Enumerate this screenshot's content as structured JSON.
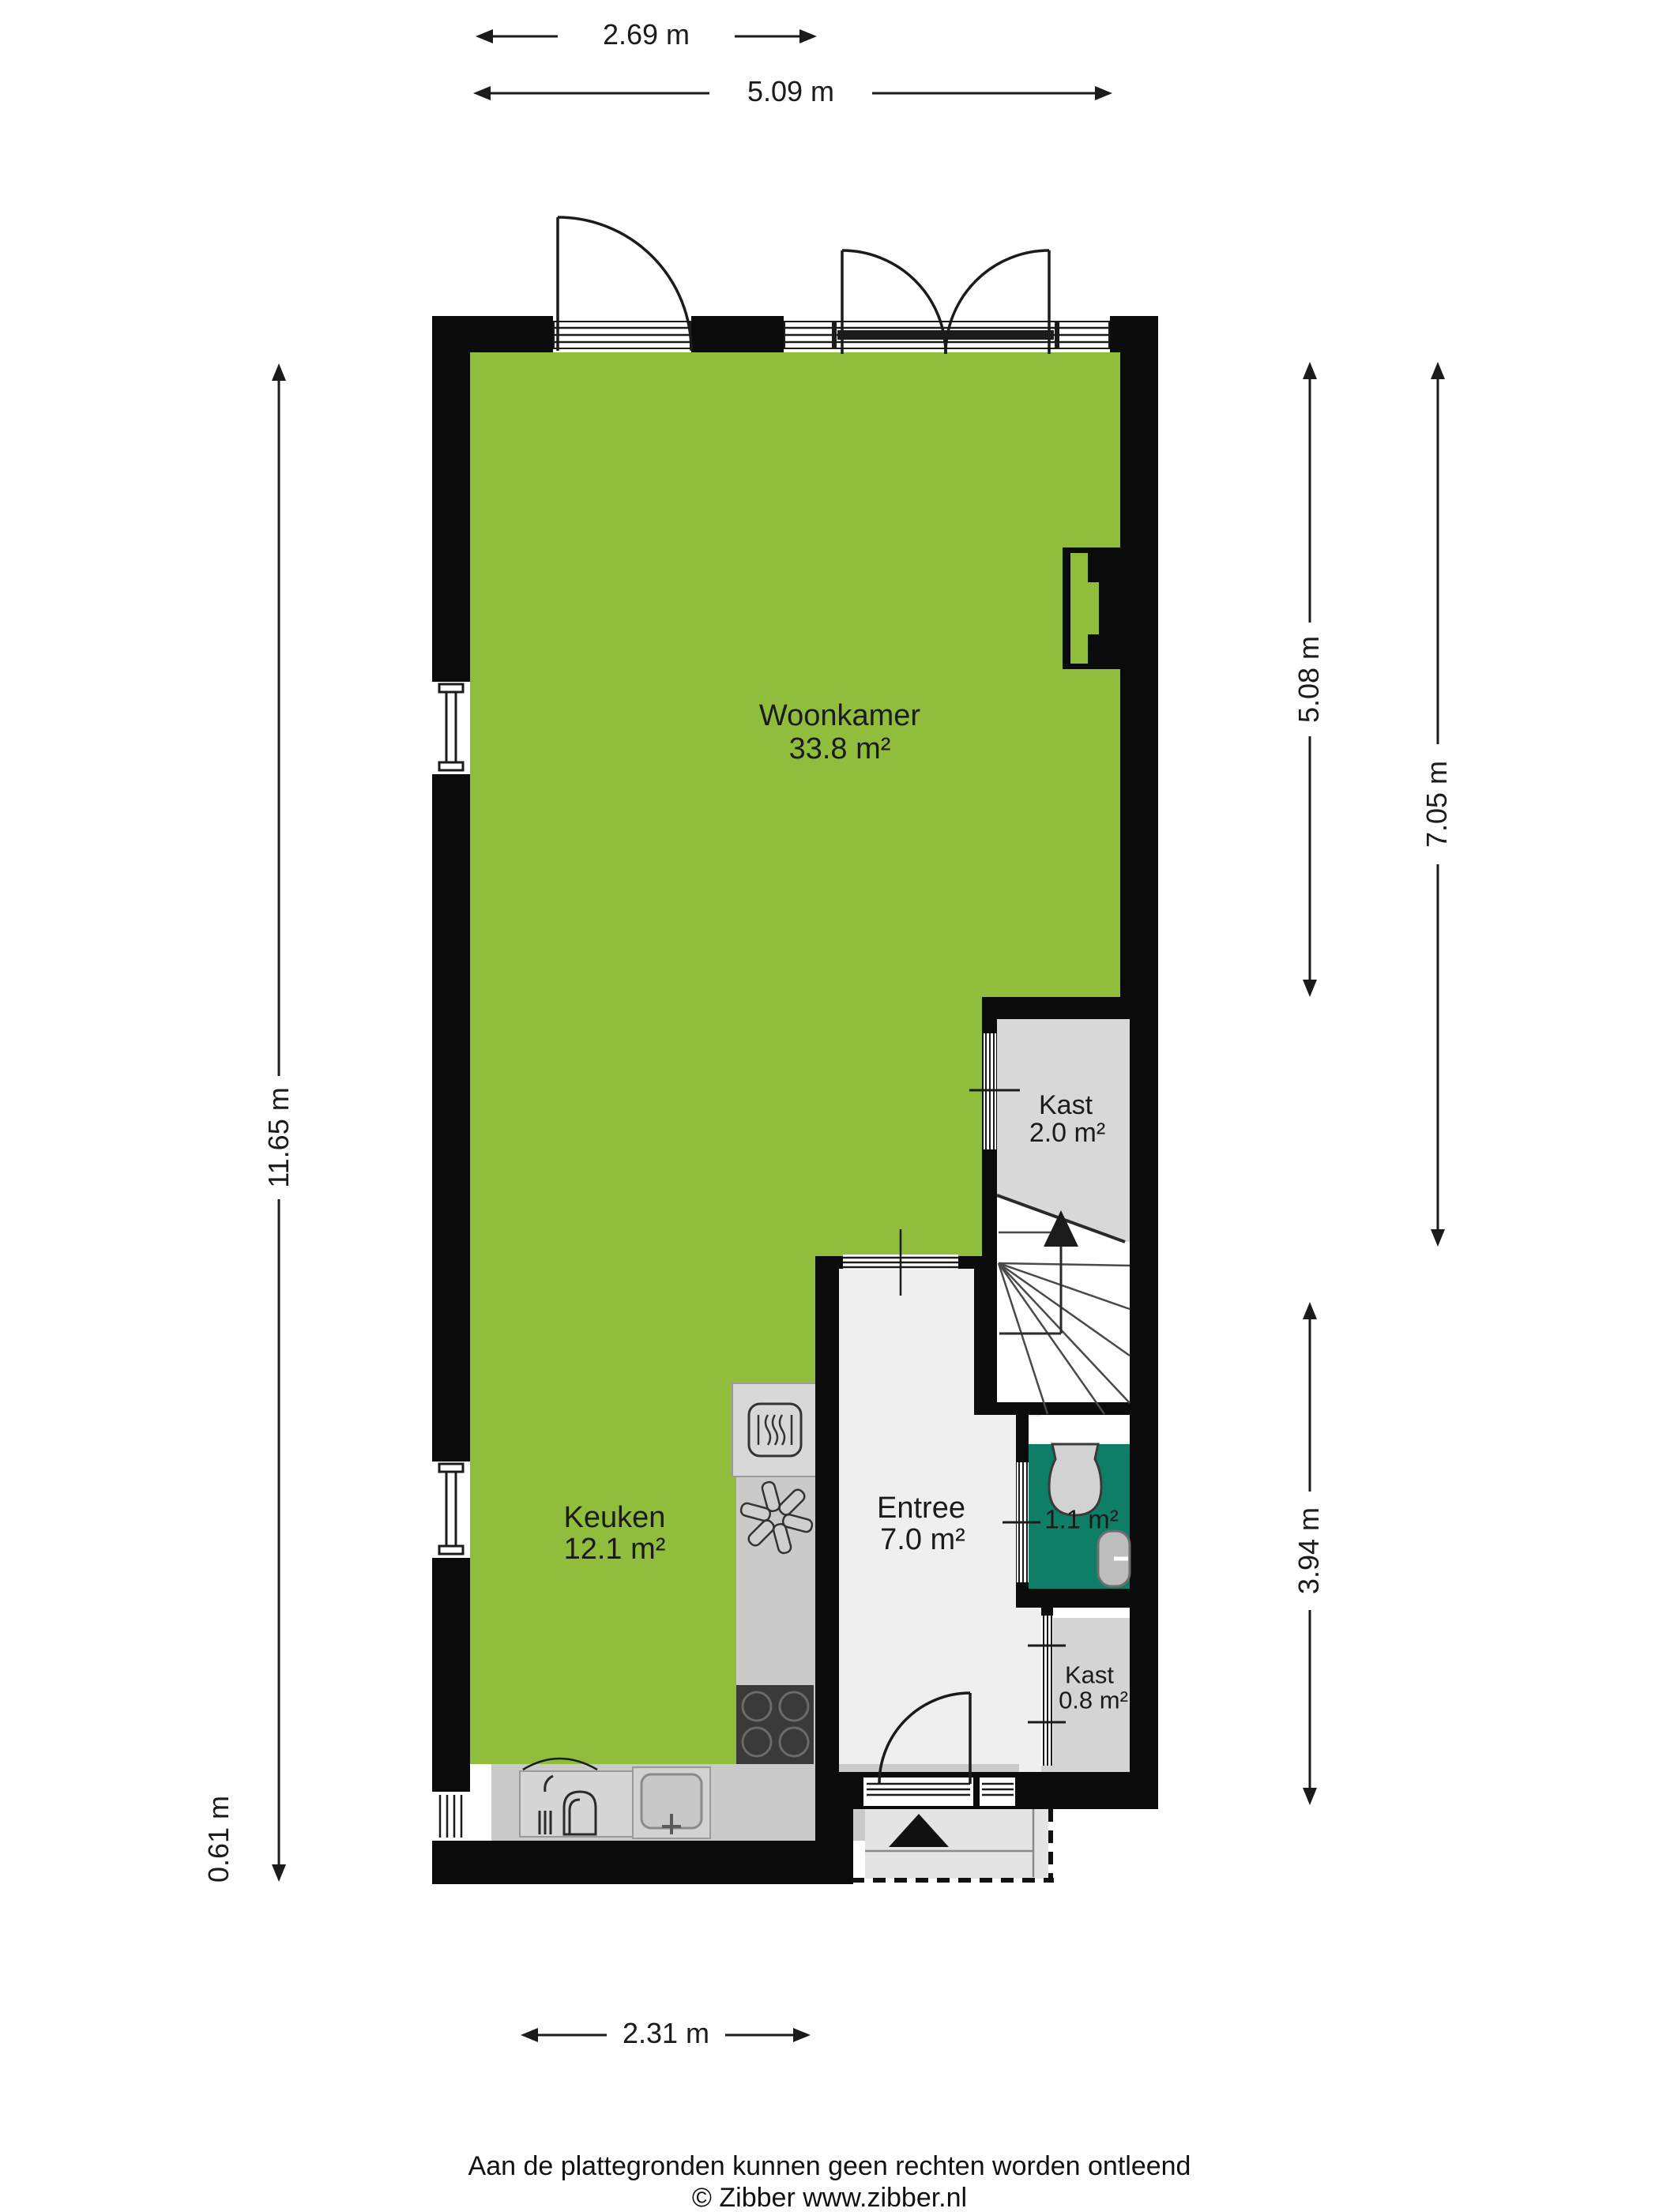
{
  "rooms": {
    "woonkamer": {
      "name": "Woonkamer",
      "area": "33.8 m²"
    },
    "keuken": {
      "name": "Keuken",
      "area": "12.1 m²"
    },
    "entree": {
      "name": "Entree",
      "area": "7.0 m²"
    },
    "kast_boven": {
      "name": "Kast",
      "area": "2.0 m²"
    },
    "toilet": {
      "name": "Toilet",
      "area": "1.1 m²"
    },
    "kast_onder": {
      "name": "Kast",
      "area": "0.8 m²"
    }
  },
  "dimensions": {
    "top_small": "2.69 m",
    "top_large": "5.09 m",
    "left_main": "11.65 m",
    "left_small": "0.61 m",
    "right_upper": "5.08 m",
    "right_full": "7.05 m",
    "right_lower": "3.94 m",
    "bottom": "2.31 m"
  },
  "footer": {
    "disclaimer": "Aan de plattegronden kunnen geen rechten worden ontleend",
    "credit": "© Zibber www.zibber.nl"
  },
  "colors": {
    "living_green": "#90BE3C",
    "toilet_teal": "#0F7E67",
    "closet_gray": "#D8D8D8",
    "entree_gray": "#EFEFEF",
    "counter_gray": "#CACACA",
    "cooktop_dark": "#3A3A3A",
    "wall_black": "#0B0B0B"
  }
}
